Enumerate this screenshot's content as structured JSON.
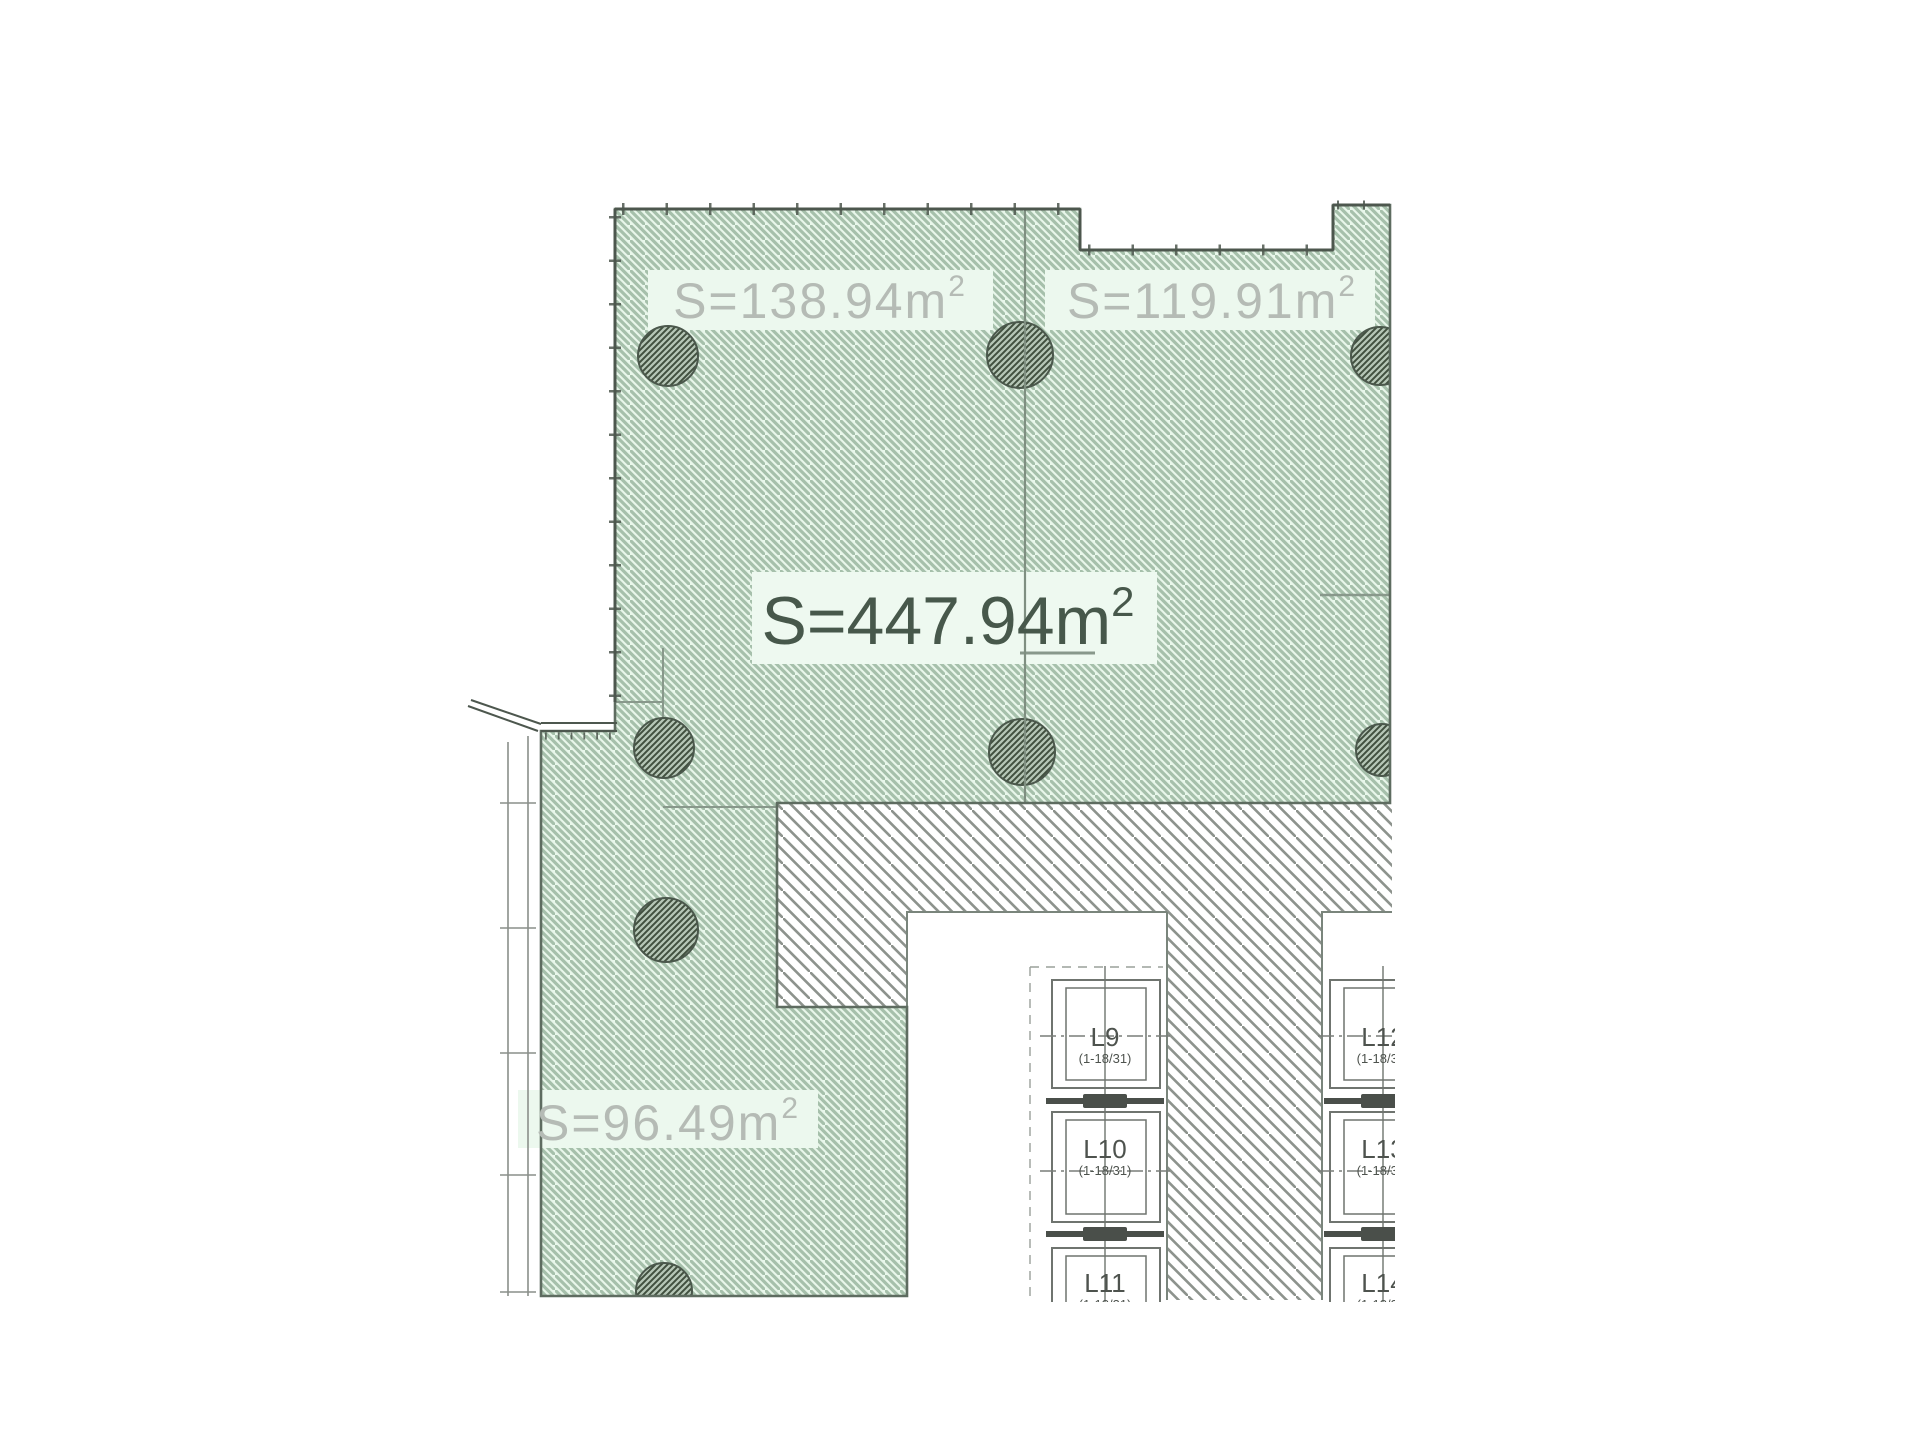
{
  "plan": {
    "area_labels": [
      {
        "id": "unit-a",
        "text": "S=138.94m",
        "sup": "2"
      },
      {
        "id": "unit-b",
        "text": "S=119.91m",
        "sup": "2"
      },
      {
        "id": "total",
        "text": "S=447.94m",
        "sup": "2"
      },
      {
        "id": "unit-c",
        "text": "S=96.49m",
        "sup": "2"
      }
    ],
    "elevators": {
      "left": [
        {
          "label": "L9",
          "range": "(1-18/31)"
        },
        {
          "label": "L10",
          "range": "(1-18/31)"
        },
        {
          "label": "L11",
          "range": "(1-18/31)"
        }
      ],
      "right": [
        {
          "label": "L12",
          "range": "(1-18/31)"
        },
        {
          "label": "L13",
          "range": "(1-18/31)"
        },
        {
          "label": "L14",
          "range": "(1-18/31)"
        }
      ]
    },
    "colors": {
      "green_fill": "#e8f6ea",
      "green_halo": "#ecf8ee",
      "green_hatch": "#a6c0ab",
      "gray_hatch": "#8d938d",
      "wall": "#4d574e",
      "green_edge": "#5e6c60",
      "corridor_edge": "#7a857c",
      "label_gray": "#b5bbb5",
      "label_dark": "#47584b",
      "elevator_text": "#4e534e",
      "column_line": "#41503f"
    }
  }
}
